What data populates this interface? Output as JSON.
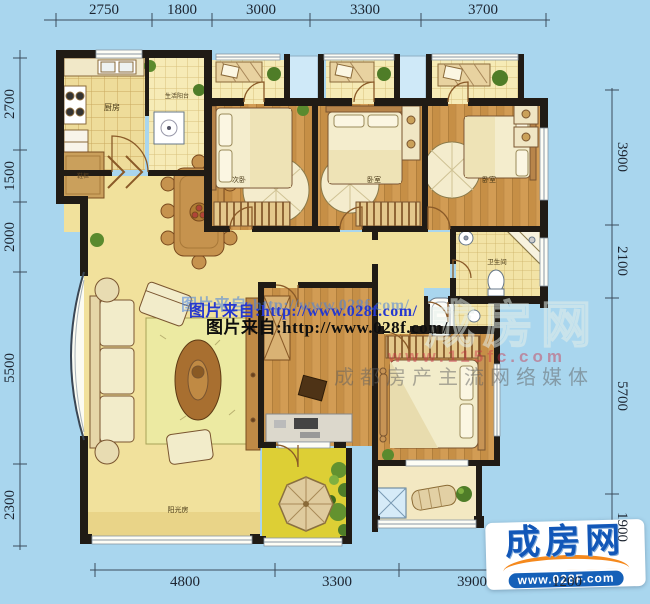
{
  "dims": {
    "top": [
      "2750",
      "1800",
      "3000",
      "3300",
      "3700"
    ],
    "left": [
      "2700",
      "1500",
      "2000",
      "5500",
      "2300"
    ],
    "right": [
      "3900",
      "2100",
      "5700",
      "1900"
    ],
    "bottom": [
      "4800",
      "3300",
      "3900",
      "1200"
    ]
  },
  "rooms": {
    "kitchen": "厨房",
    "service_balcony": "生活阳台",
    "shoe_cabinet": "鞋柜",
    "bedroom1": "次卧",
    "bedroom2": "卧室",
    "bedroom3": "卧室",
    "bathroom": "卫生间",
    "sunroom": "阳光房"
  },
  "watermarks": {
    "photo_credit_blue": "图片来自:http://www.028f.com/",
    "photo_credit_black": "图片来自:http://www.028f.com/",
    "ghost_logo": "成房网",
    "ghost_url": "www.115fc.com",
    "ghost_slogan": "成都房产主流网络媒体"
  },
  "logo": {
    "name": "成房网",
    "url": "www.028F.com"
  },
  "colors": {
    "background": "#a9d6ee",
    "wall": "#201b15",
    "floor_yellow": "#f1e19c",
    "floor_wood": "#cf9a52",
    "logo_blue": "#1257b8",
    "logo_orange": "#f5891d",
    "watermark_blue": "#2638cf"
  }
}
